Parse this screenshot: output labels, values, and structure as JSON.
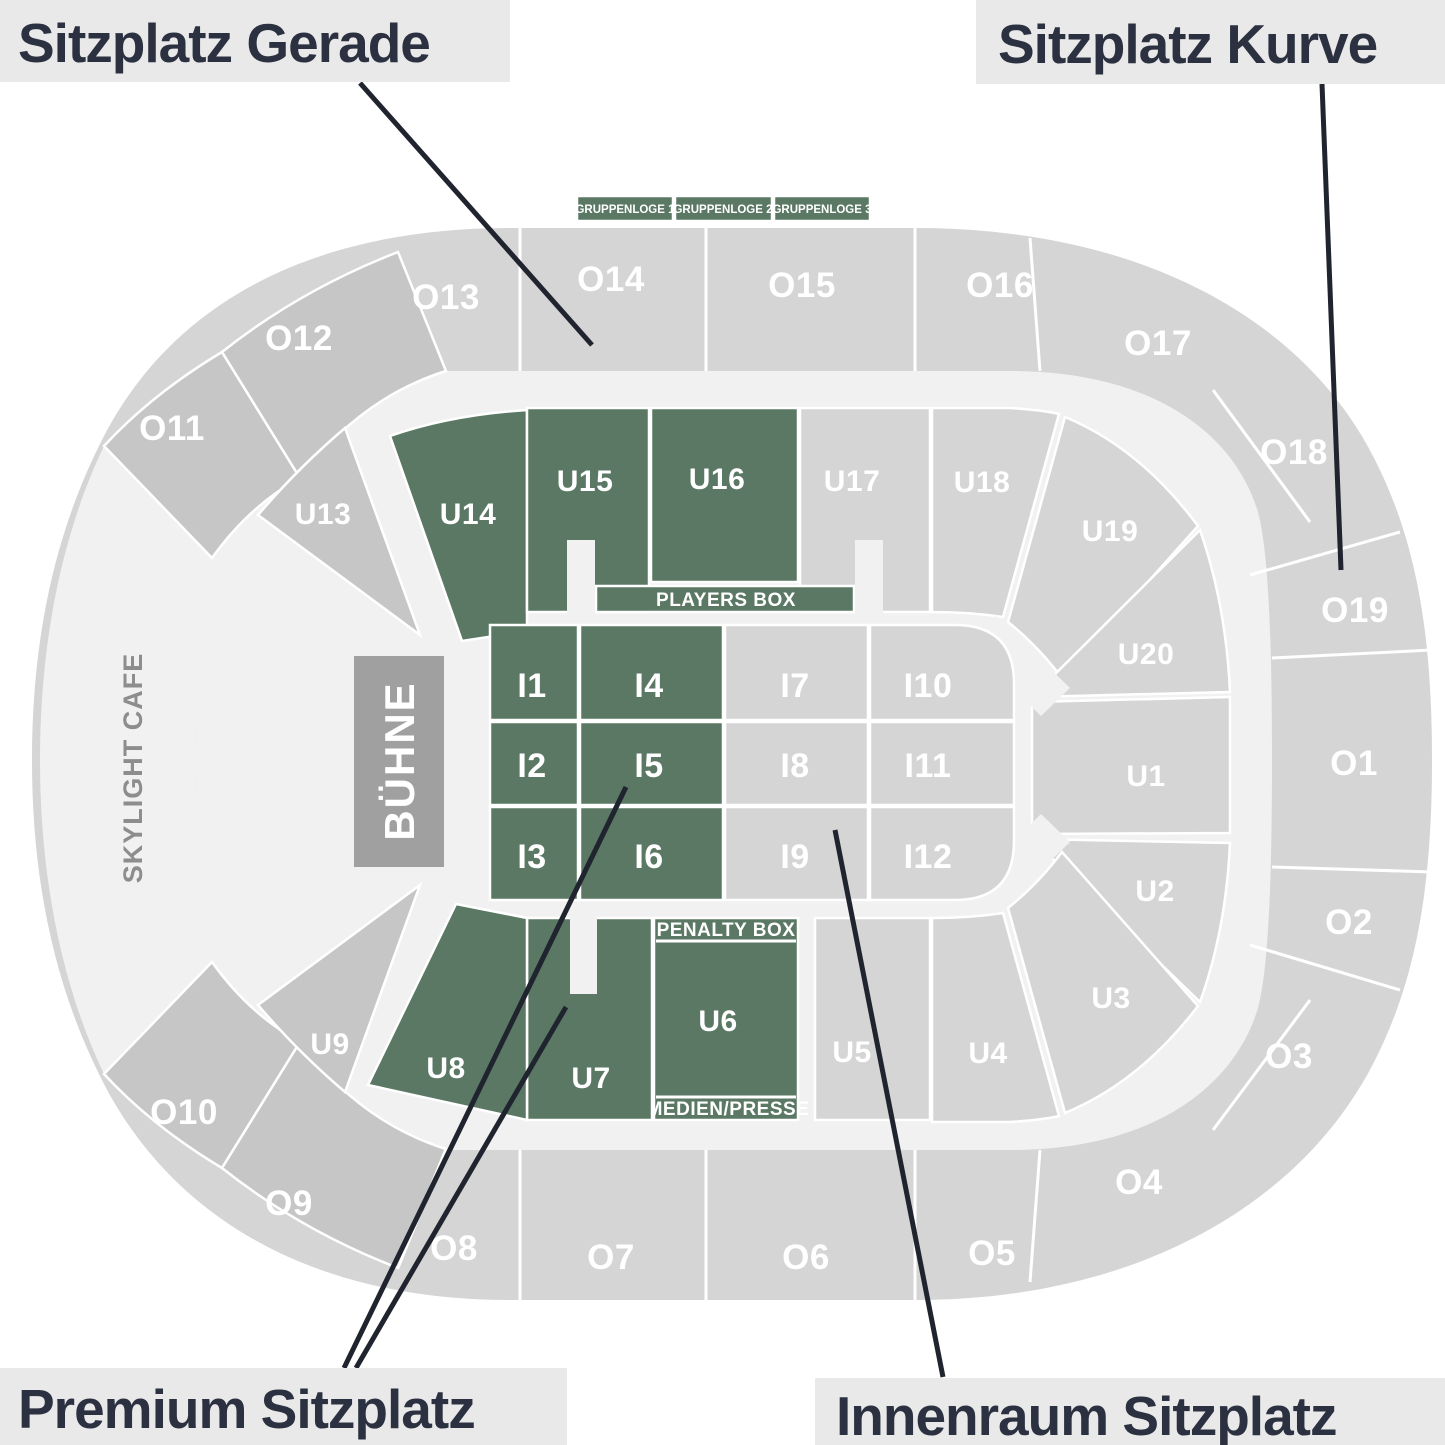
{
  "legend": {
    "top_left": "Sitzplatz Gerade",
    "top_right": "Sitzplatz Kurve",
    "bottom_left": "Premium Sitzplatz",
    "bottom_right": "Innenraum Sitzplatz"
  },
  "colors": {
    "premium_green": "#5a7864",
    "standard_gray": "#d5d5d5",
    "curve_dark_gray": "#c6c6c6",
    "concourse": "#f1f1f1",
    "stage_gray": "#a0a0a0",
    "legend_bg": "#e9e9e9",
    "legend_text": "#2b3140",
    "pointer_line": "#20242e"
  },
  "map": {
    "stage_label": "BÜHNE",
    "cafe_label": "SKYLIGHT CAFE",
    "players_box_label": "PLAYERS BOX",
    "penalty_box_label": "PENALTY BOX",
    "media_label": "MEDIEN/PRESSE",
    "gruppenlogen": [
      {
        "label": "GRUPPENLOGE 1"
      },
      {
        "label": "GRUPPENLOGE 2"
      },
      {
        "label": "GRUPPENLOGE 3"
      }
    ],
    "outer_sections": [
      {
        "label": "O11"
      },
      {
        "label": "O12"
      },
      {
        "label": "O13"
      },
      {
        "label": "O14"
      },
      {
        "label": "O15"
      },
      {
        "label": "O16"
      },
      {
        "label": "O17"
      },
      {
        "label": "O18"
      },
      {
        "label": "O19"
      },
      {
        "label": "O1"
      },
      {
        "label": "O2"
      },
      {
        "label": "O3"
      },
      {
        "label": "O4"
      },
      {
        "label": "O5"
      },
      {
        "label": "O6"
      },
      {
        "label": "O7"
      },
      {
        "label": "O8"
      },
      {
        "label": "O9"
      },
      {
        "label": "O10"
      }
    ],
    "ring_sections": [
      {
        "label": "U13"
      },
      {
        "label": "U14"
      },
      {
        "label": "U15"
      },
      {
        "label": "U16"
      },
      {
        "label": "U17"
      },
      {
        "label": "U18"
      },
      {
        "label": "U19"
      },
      {
        "label": "U20"
      },
      {
        "label": "U1"
      },
      {
        "label": "U2"
      },
      {
        "label": "U3"
      },
      {
        "label": "U4"
      },
      {
        "label": "U5"
      },
      {
        "label": "U6"
      },
      {
        "label": "U7"
      },
      {
        "label": "U8"
      },
      {
        "label": "U9"
      }
    ],
    "field_sections": [
      {
        "label": "I1"
      },
      {
        "label": "I2"
      },
      {
        "label": "I3"
      },
      {
        "label": "I4"
      },
      {
        "label": "I5"
      },
      {
        "label": "I6"
      },
      {
        "label": "I7"
      },
      {
        "label": "I8"
      },
      {
        "label": "I9"
      },
      {
        "label": "I10"
      },
      {
        "label": "I11"
      },
      {
        "label": "I12"
      }
    ]
  }
}
